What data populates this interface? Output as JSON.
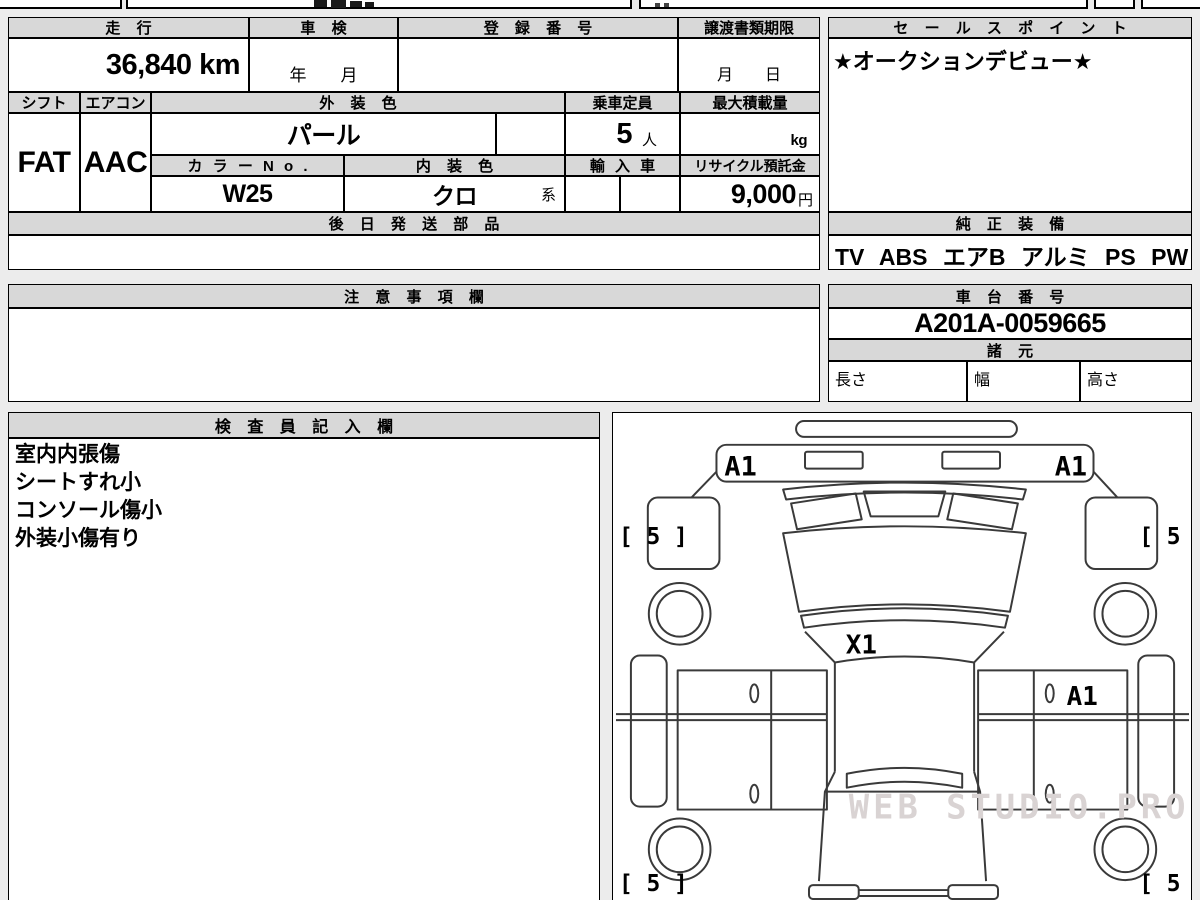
{
  "colors": {
    "page_bg": "#ececec",
    "cell_bg": "#ffffff",
    "header_bg": "#d8d8d8",
    "border": "#000000",
    "car_line": "#3a3a3a",
    "watermark": "#d9d3d3"
  },
  "main": {
    "mileage": {
      "label": "走 行",
      "value": "36,840 km"
    },
    "inspection": {
      "label": "車 検",
      "value": "年　　月"
    },
    "registration": {
      "label": "登 録 番 号",
      "value": ""
    },
    "transfer": {
      "label": "譲渡書類期限",
      "value": "月　　日"
    },
    "shift": {
      "label": "シフト",
      "value": "FAT"
    },
    "aircon": {
      "label": "エアコン",
      "value": "AAC"
    },
    "exterior_color": {
      "label": "外 装 色",
      "value": "パール"
    },
    "capacity": {
      "label": "乗車定員",
      "value": "5",
      "unit": "人"
    },
    "max_load": {
      "label": "最大積載量",
      "value": "",
      "unit": "kg"
    },
    "color_no": {
      "label": "カ ラ ー N o .",
      "value": "W25"
    },
    "interior_color": {
      "label": "内 装 色",
      "value": "クロ",
      "suffix": "系"
    },
    "import_car": {
      "label": "輸 入 車",
      "value": ""
    },
    "recycle_deposit": {
      "label": "リサイクル預託金",
      "value": "9,000",
      "unit": "円"
    },
    "later_parts": {
      "label": "後 日 発 送 部 品",
      "value": ""
    },
    "sales_point": {
      "label": "セ ー ル ス ポ イ ン ト",
      "value": "★オークションデビュー★"
    },
    "genuine_equipment": {
      "label": "純 正 装 備",
      "value": "TV ABS エアB アルミ PS PW"
    },
    "notes": {
      "label": "注 意 事 項 欄",
      "value": ""
    },
    "chassis_no": {
      "label": "車 台 番 号",
      "value": "A201A-0059665"
    },
    "specs": {
      "label": "諸 元",
      "length_label": "長さ",
      "width_label": "幅",
      "height_label": "高さ"
    },
    "inspector": {
      "label": "検 査 員 記 入 欄",
      "lines": [
        "室内内張傷",
        "シートすれ小",
        "コンソール傷小",
        "外装小傷有り"
      ]
    }
  },
  "diagram": {
    "front_left_mark": "A1",
    "front_right_mark": "A1",
    "glass_mark": "X1",
    "right_door_mark": "A1",
    "tire_front_left": "[ 5 ]",
    "tire_front_right": "[ 5 ]",
    "tire_rear_left": "[ 5 ]",
    "tire_rear_right": "[ 5 ]",
    "watermark": "WEB STUDIO.PRO"
  }
}
